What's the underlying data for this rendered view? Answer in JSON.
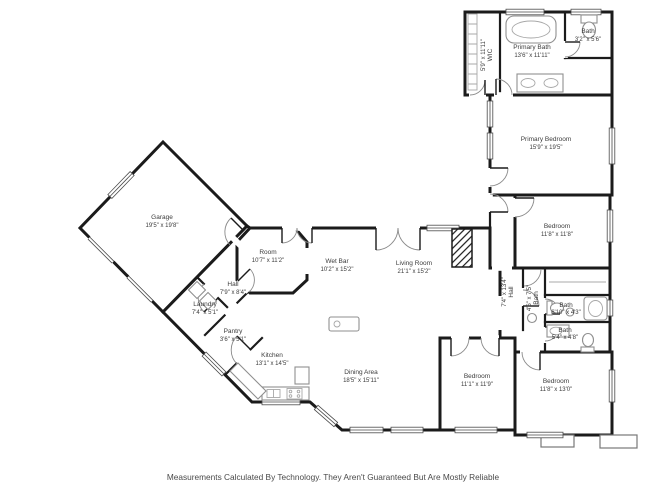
{
  "app": {
    "background": "#ffffff",
    "wall_color": "#1b1b1b",
    "fixture_color": "#8f8f8f",
    "label_color": "#3c3c3c"
  },
  "footer": {
    "disclaimer": "Measurements Calculated By Technology. They Aren't Guaranteed But Are Mostly Reliable"
  },
  "rooms": {
    "garage": {
      "name": "Garage",
      "dims": "19'5\" x 19'8\""
    },
    "room": {
      "name": "Room",
      "dims": "10'7\" x 11'2\""
    },
    "wet_bar": {
      "name": "Wet Bar",
      "dims": "10'2\" x 15'2\""
    },
    "living_room": {
      "name": "Living Room",
      "dims": "21'1\" x 15'2\""
    },
    "dining_area": {
      "name": "Dining Area",
      "dims": "18'5\" x 15'11\""
    },
    "kitchen": {
      "name": "Kitchen",
      "dims": "13'1\" x 14'5\""
    },
    "pantry": {
      "name": "Pantry",
      "dims": "3'6\" x 5'1\""
    },
    "laundry": {
      "name": "Laundry",
      "dims": "7'4\" x 5'1\""
    },
    "hall_entry": {
      "name": "Hall",
      "dims": "7'9\" x 8'4\""
    },
    "hall_bedrooms": {
      "name": "Hall",
      "dims": "7'4\" x 13'4\""
    },
    "wic": {
      "name": "WIC",
      "dims": "5'9\" x 11'11\""
    },
    "primary_bath": {
      "name": "Primary Bath",
      "dims": "13'6\" x 11'11\""
    },
    "bath_top": {
      "name": "Bath",
      "dims": "3'2\" x 5'6\""
    },
    "bath_hall": {
      "name": "Bath",
      "dims": "4'6\" x 7'5\""
    },
    "bath_mid": {
      "name": "Bath",
      "dims": "6'10\" x 4'3\""
    },
    "bath_low": {
      "name": "Bath",
      "dims": "5'4\" x 4'8\""
    },
    "primary_bedroom": {
      "name": "Primary Bedroom",
      "dims": "15'9\" x 19'5\""
    },
    "bedroom_ne": {
      "name": "Bedroom",
      "dims": "11'8\" x 11'8\""
    },
    "bedroom_s": {
      "name": "Bedroom",
      "dims": "11'1\" x 11'9\""
    },
    "bedroom_se": {
      "name": "Bedroom",
      "dims": "11'8\" x 13'0\""
    }
  }
}
